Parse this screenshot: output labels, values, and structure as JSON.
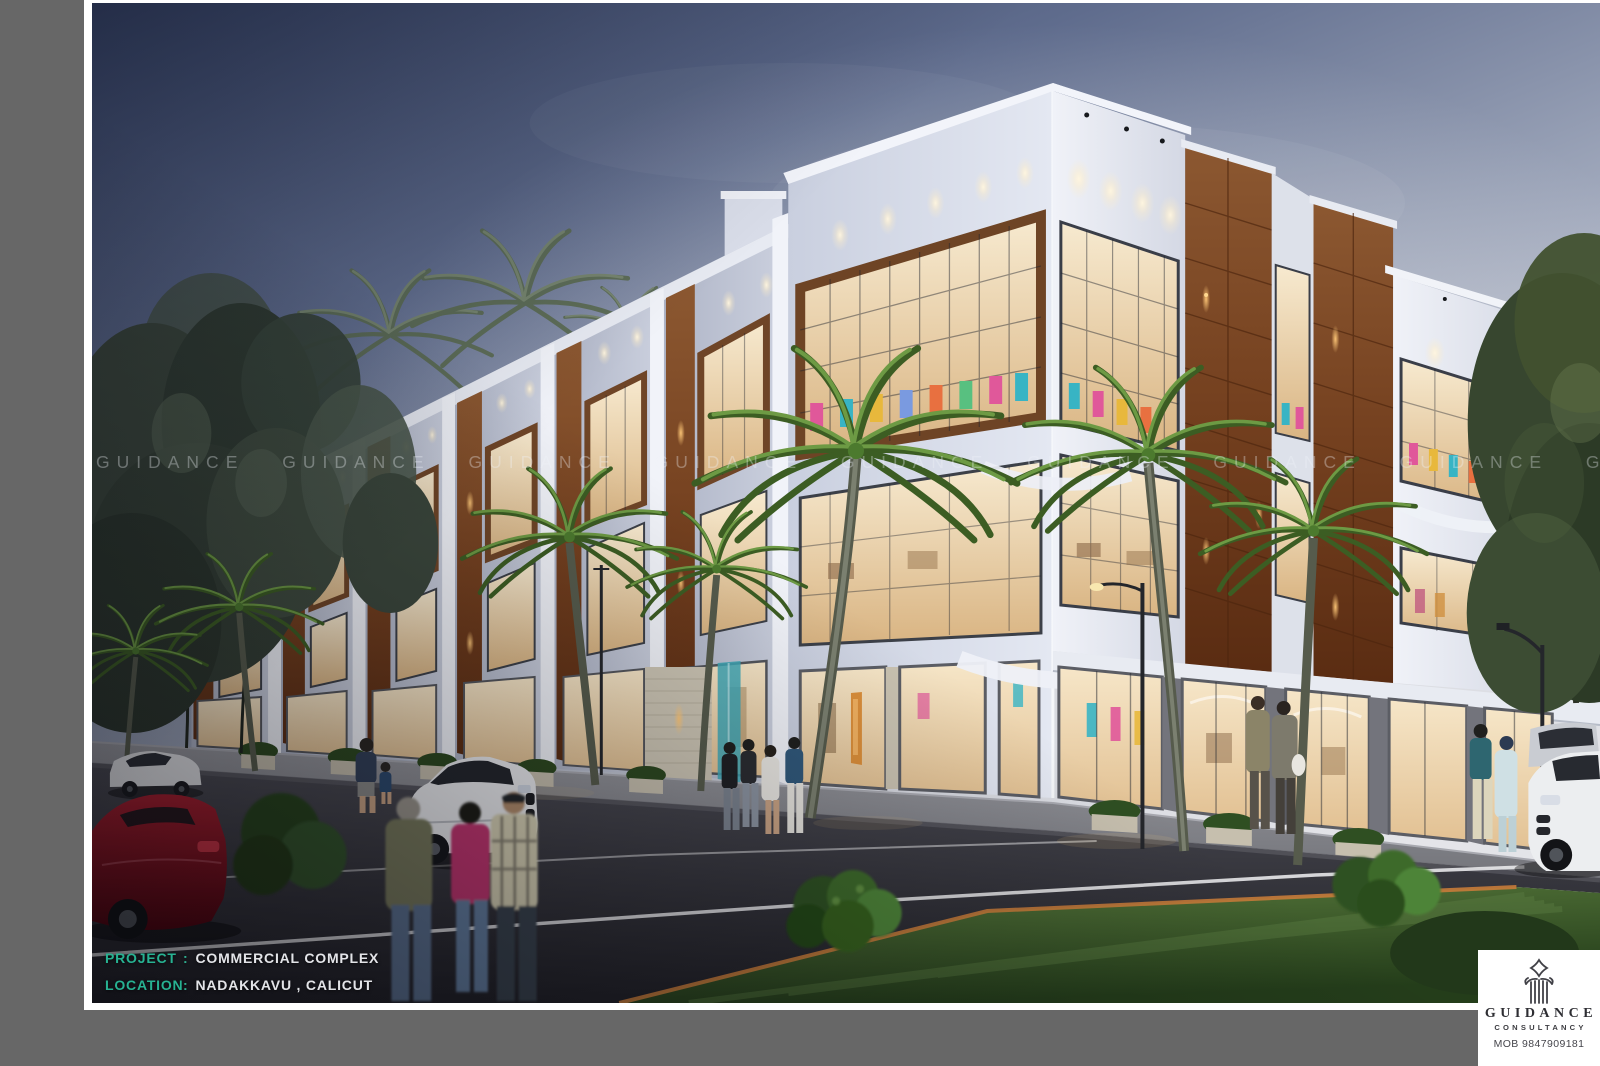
{
  "watermark": {
    "word": "GUIDANCE",
    "line": "GUIDANCE GUIDANCE GUIDANCE GUIDANCE GUIDANCE GUIDANCE GUIDANCE GUIDANCE GUIDANCE"
  },
  "caption": {
    "project_label": "PROJECT",
    "project_sep": ":",
    "project_value": "COMMERCIAL COMPLEX",
    "location_label": "LOCATION",
    "location_sep": ":",
    "location_value": "NADAKKAVU , CALICUT"
  },
  "logo": {
    "name": "GUIDANCE",
    "subtitle": "CONSULTANCY",
    "phone": "MOB 9847909181"
  },
  "palette": {
    "page_background": "#676767",
    "frame": "#ffffff",
    "caption_label_teal": "#27b292",
    "caption_value": "#e3e4e8",
    "sky_top": "#323e60",
    "sky_light": "#e2e3e8",
    "wood_panel": "#74401f",
    "palm_green": "#4c7a2e",
    "road": "#2a2a30",
    "lawn_green": "#3c5a28",
    "interior_glow": "#f3e2c2",
    "logo_text": "#2e2e33"
  }
}
